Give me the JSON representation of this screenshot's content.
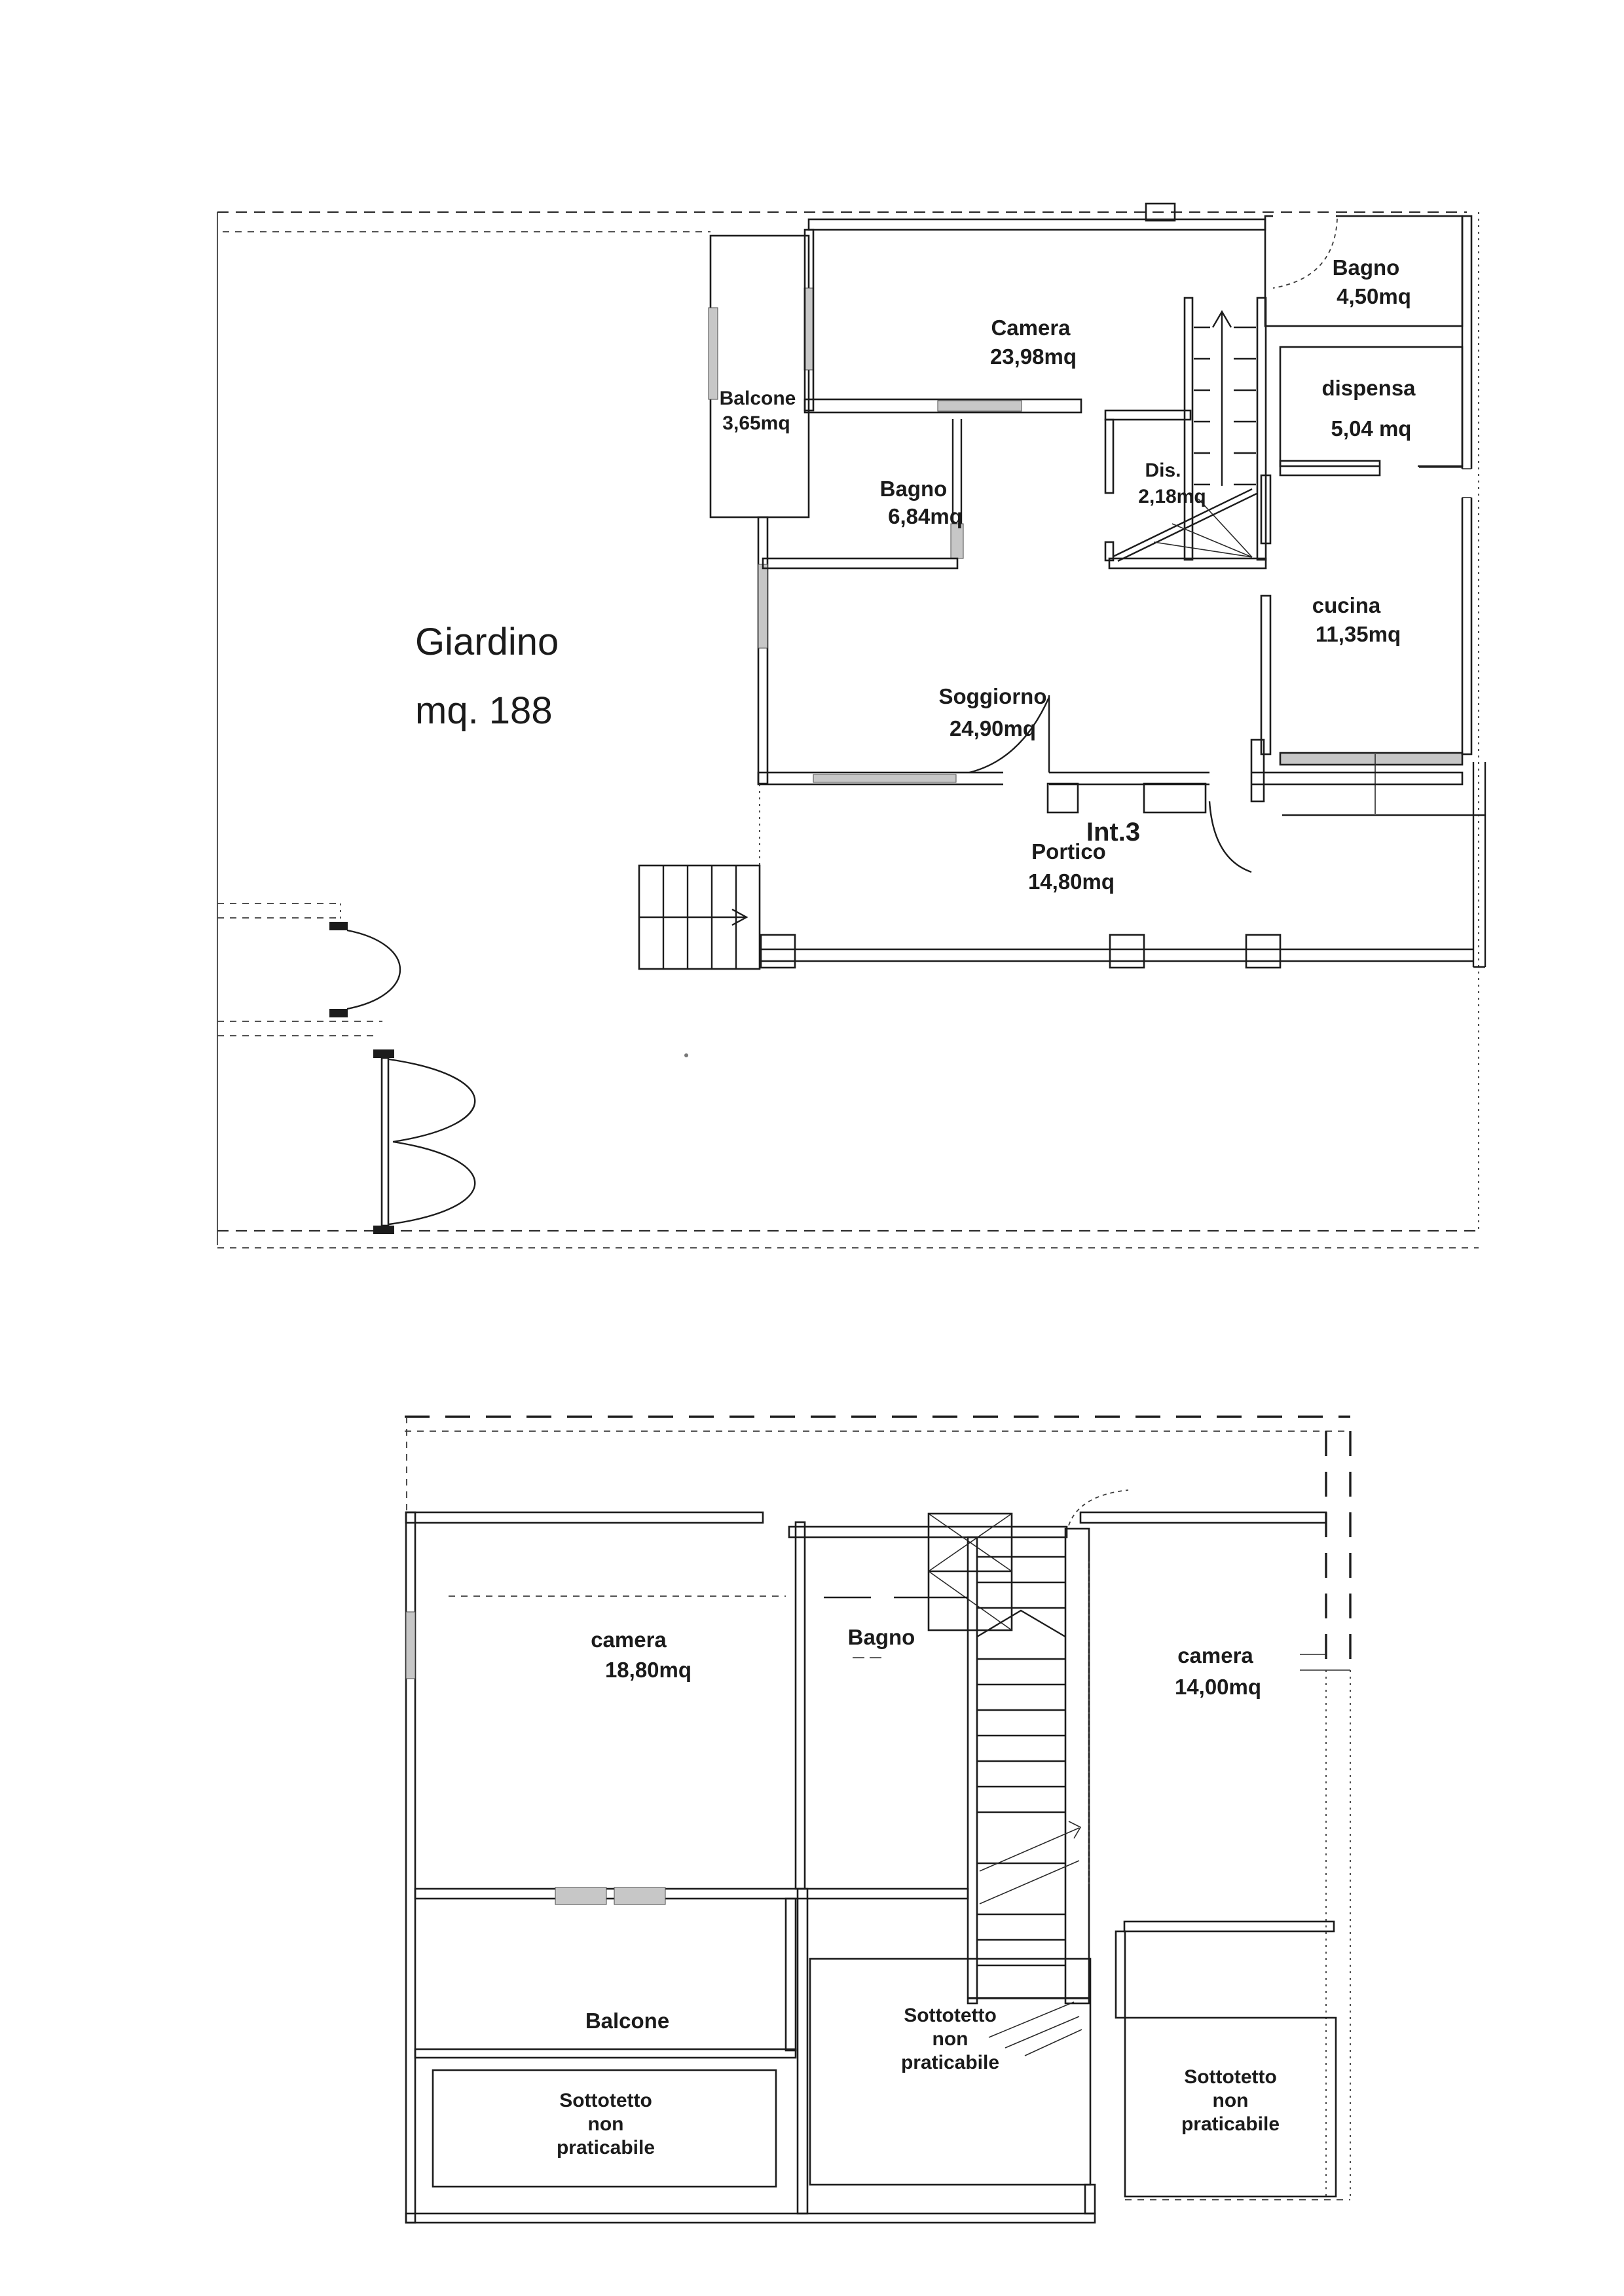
{
  "document": {
    "kind": "scanned floor plan, two storeys",
    "ink_color": "#1c1c1c",
    "paper_color": "#ffffff"
  },
  "plan_upper": {
    "garden_name": "Giardino",
    "garden_area": "mq. 188",
    "unit_label": "Int.3",
    "rooms": {
      "balcone": {
        "label": "Balcone",
        "area": "3,65mq"
      },
      "camera": {
        "label": "Camera",
        "area": "23,98mq"
      },
      "bagno_sup": {
        "label": "Bagno",
        "area": "4,50mq"
      },
      "dispensa": {
        "label": "dispensa",
        "area": "5,04 mq"
      },
      "bagno_inf": {
        "label": "Bagno",
        "area": "6,84mq"
      },
      "dis": {
        "label": "Dis.",
        "area": "2,18mq"
      },
      "cucina": {
        "label": "cucina",
        "area": "11,35mq"
      },
      "soggiorno": {
        "label": "Soggiorno",
        "area": "24,90mq"
      },
      "portico": {
        "label": "Portico",
        "area": "14,80mq"
      }
    }
  },
  "plan_lower": {
    "rooms": {
      "camera_grande": {
        "label": "camera",
        "area": "18,80mq"
      },
      "bagno": {
        "label": "Bagno"
      },
      "camera_piccola": {
        "label": "camera",
        "area": "14,00mq"
      },
      "balcone": {
        "label": "Balcone"
      }
    },
    "sottotetto": {
      "line1": "Sottotetto",
      "line2": "non",
      "line3": "praticabile"
    }
  }
}
